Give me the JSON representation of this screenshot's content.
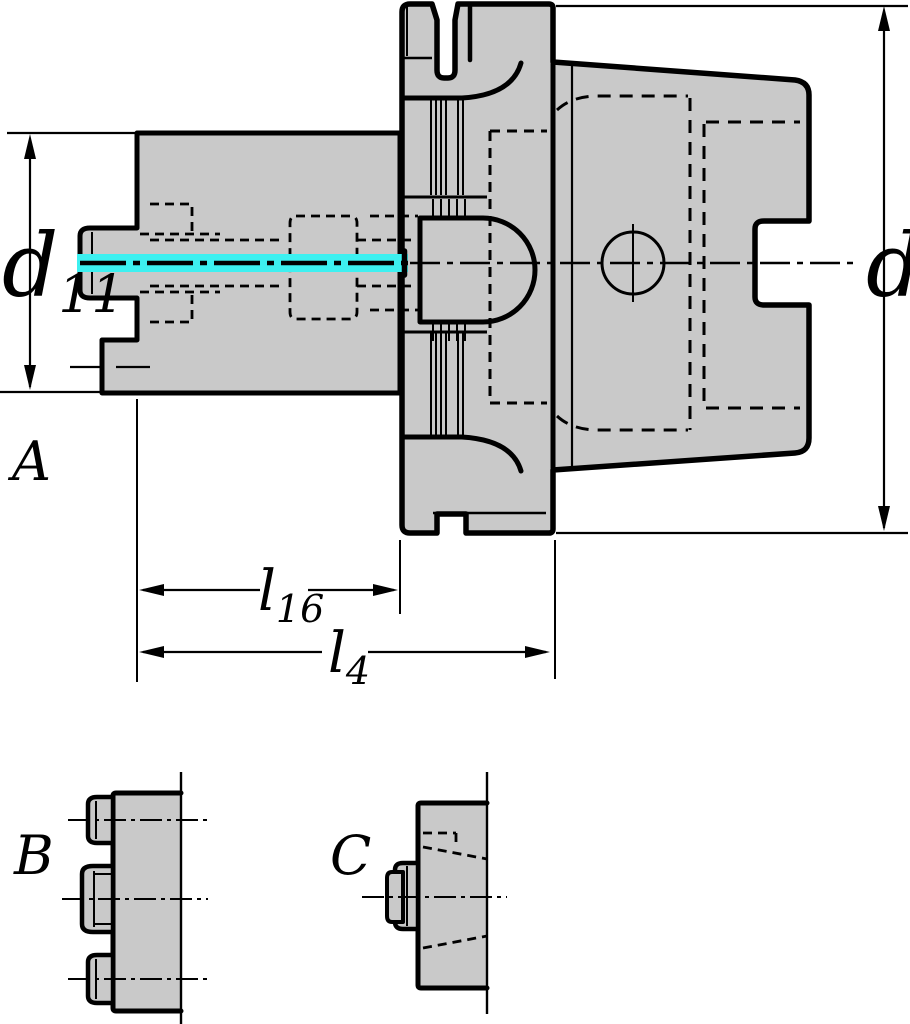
{
  "drawing": {
    "colors": {
      "background": "#ffffff",
      "body_fill": "#c9c9c9",
      "line": "#000000",
      "highlight_cyan": "#3df0f0"
    },
    "views": {
      "main": {
        "label": "A"
      },
      "detail_b": {
        "label": "B"
      },
      "detail_c": {
        "label": "C"
      }
    },
    "dimensions": {
      "d11": {
        "base": "d",
        "sub": "11"
      },
      "d1": {
        "base": "d",
        "sub": "1"
      },
      "l16": {
        "base": "l",
        "sub": "16"
      },
      "l4": {
        "base": "l",
        "sub": "4"
      }
    }
  }
}
